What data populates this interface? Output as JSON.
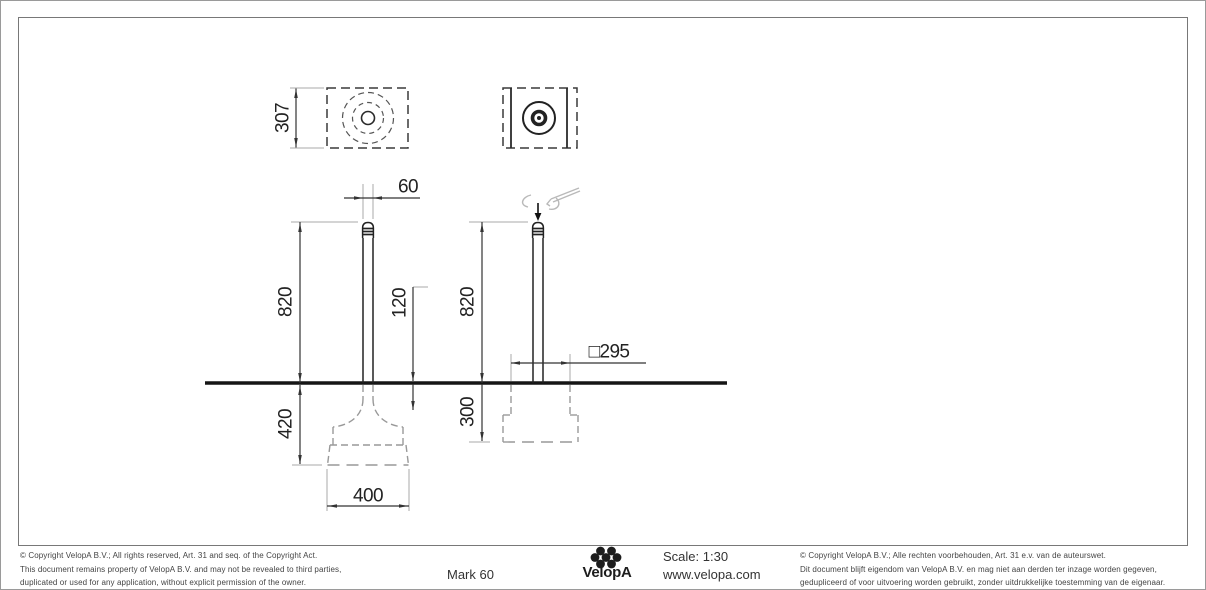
{
  "sheet": {
    "background": "#ffffff",
    "outer_border_color": "#9a9a9a",
    "frame_color": "#787878",
    "line_color": "#2b2b2b",
    "extension_line_color": "#aaaaaa",
    "hidden_line_color": "#999999",
    "tool_symbol_color": "#b9b9b9"
  },
  "dimensions": {
    "plan_height": "307",
    "post_width": "60",
    "post_height_left": "820",
    "inset_depth": "120",
    "post_height_right": "820",
    "foundation_square": "□295",
    "foundation_depth_left": "420",
    "foundation_depth_right": "300",
    "foundation_width": "400"
  },
  "title_block": {
    "copyright_en_1": "© Copyright VelopA B.V.; All rights reserved, Art. 31 and seq. of the Copyright Act.",
    "copyright_en_2": "This document remains property of VelopA B.V. and may not be revealed to third parties,",
    "copyright_en_3": "duplicated or used for any application, without explicit permission of the owner.",
    "product_name": "Mark 60",
    "brand_name": "VelopA",
    "scale": "Scale: 1:30",
    "website": "www.velopa.com",
    "copyright_nl_1": "© Copyright VelopA B.V.; Alle rechten voorbehouden, Art. 31 e.v. van de auteurswet.",
    "copyright_nl_2": "Dit document blijft eigendom van VelopA B.V. en mag niet aan derden ter inzage worden gegeven,",
    "copyright_nl_3": "gedupliceerd of voor uitvoering worden gebruikt, zonder uitdrukkelijke toestemming van de eigenaar."
  }
}
